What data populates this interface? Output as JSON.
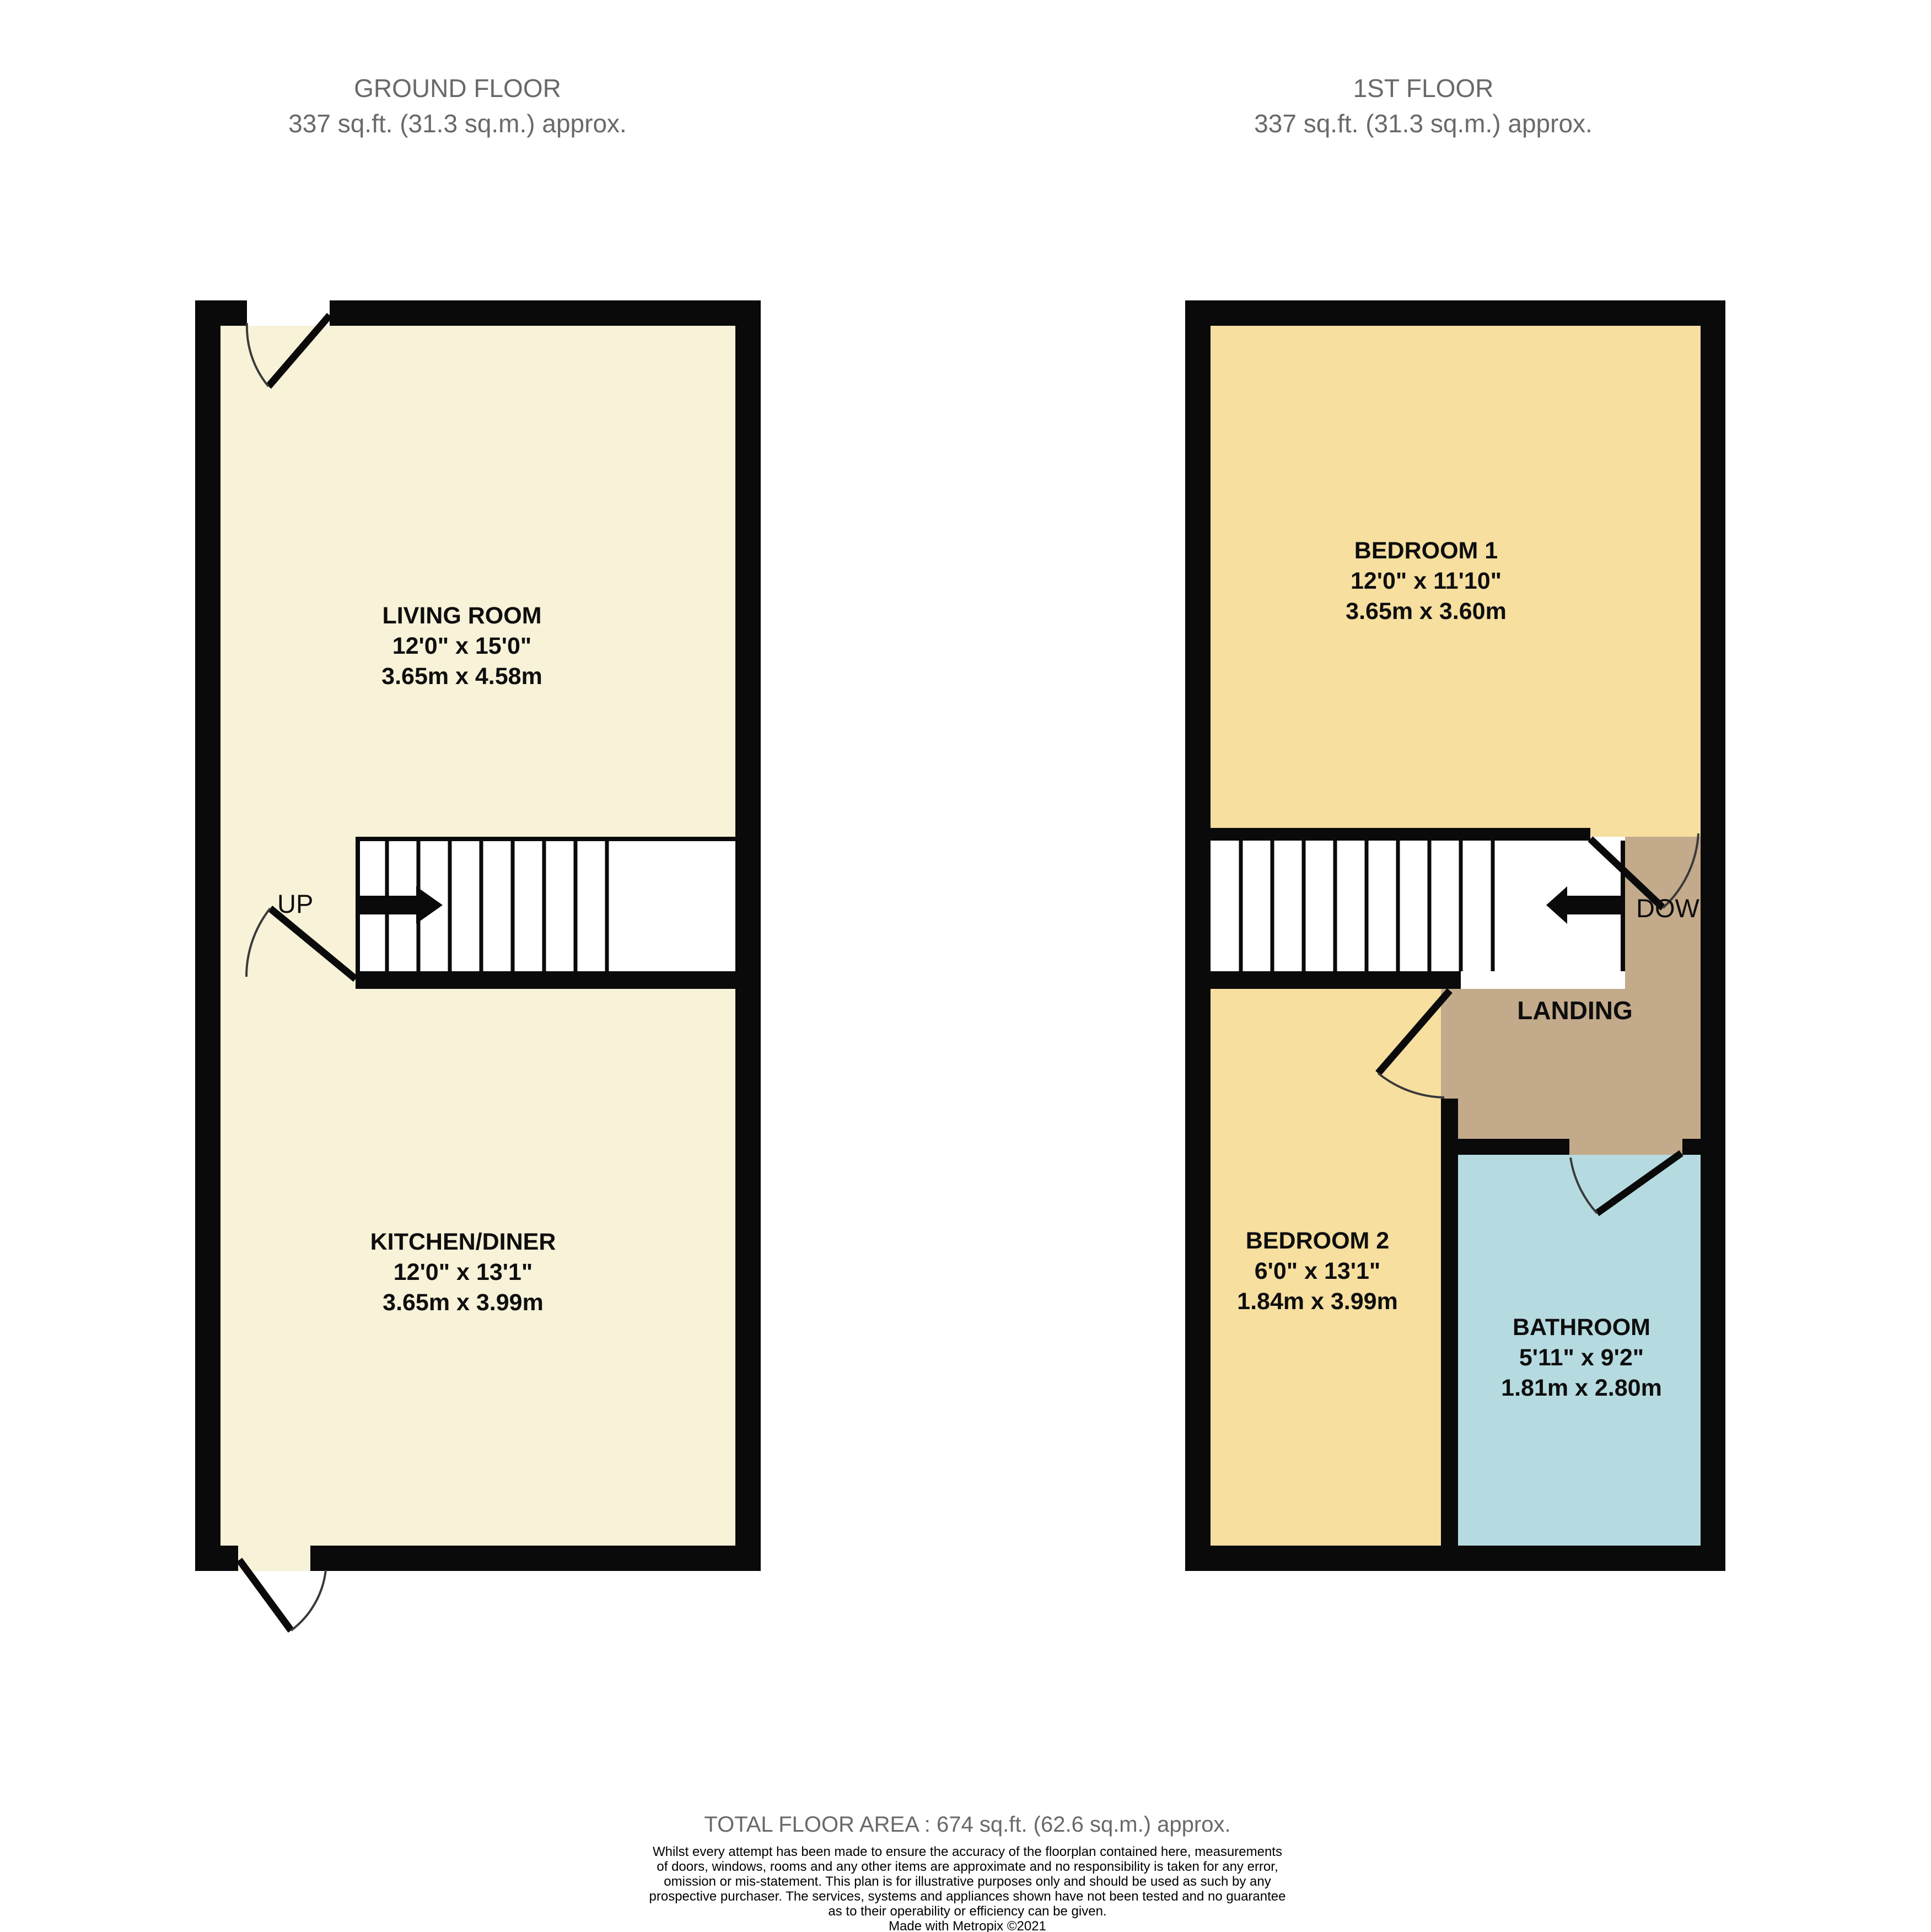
{
  "ground_floor": {
    "title": "GROUND FLOOR",
    "area": "337 sq.ft. (31.3 sq.m.) approx.",
    "stair_label": "UP",
    "rooms": [
      {
        "name": "LIVING ROOM",
        "imperial": "12'0\"  x 15'0\"",
        "metric": "3.65m  x 4.58m"
      },
      {
        "name": "KITCHEN/DINER",
        "imperial": "12'0\"  x 13'1\"",
        "metric": "3.65m  x 3.99m"
      }
    ]
  },
  "first_floor": {
    "title": "1ST FLOOR",
    "area": "337 sq.ft. (31.3 sq.m.) approx.",
    "stair_label": "DOWN",
    "landing_label": "LANDING",
    "rooms": [
      {
        "name": "BEDROOM 1",
        "imperial": "12'0\"  x 11'10\"",
        "metric": "3.65m  x 3.60m"
      },
      {
        "name": "BEDROOM 2",
        "imperial": "6'0\"  x 13'1\"",
        "metric": "1.84m  x 3.99m"
      },
      {
        "name": "BATHROOM",
        "imperial": "5'11\"  x 9'2\"",
        "metric": "1.81m  x 2.80m"
      }
    ]
  },
  "footer": {
    "total_area": "TOTAL FLOOR AREA : 674 sq.ft. (62.6 sq.m.) approx.",
    "disclaimer_lines": [
      "Whilst every attempt has been made to ensure the accuracy of the floorplan contained here, measurements",
      "of doors, windows, rooms and any other items are approximate and no responsibility is taken for any error,",
      "omission or mis-statement. This plan is for illustrative purposes only and should be used as such by any",
      "prospective purchaser. The services, systems and appliances shown have not been tested and no guarantee",
      "as to their operability or efficiency can be given."
    ],
    "credit": "Made with Metropix ©2021"
  },
  "colors": {
    "room_cream": "#f7f2d8",
    "room_yellow": "#f6df9f",
    "landing_brown": "#c3aa8b",
    "bathroom_blue": "#b5dbe0",
    "wall_black": "#0a0a0a",
    "muted_text": "#696969"
  }
}
